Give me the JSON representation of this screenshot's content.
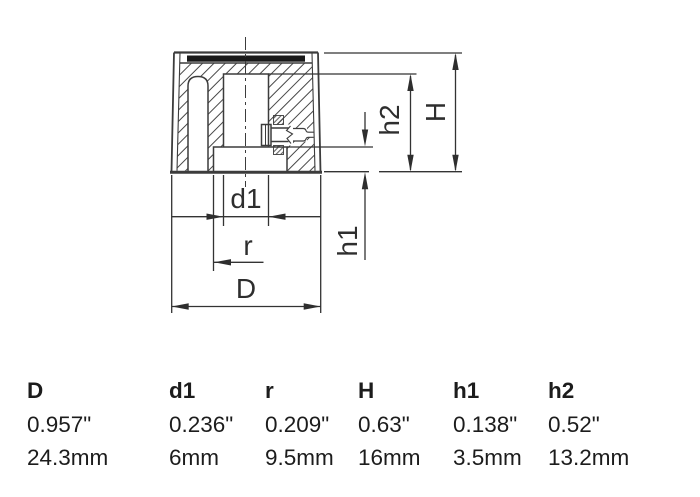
{
  "drawing": {
    "labels": {
      "D": "D",
      "d1": "d1",
      "r": "r",
      "H": "H",
      "h1": "h1",
      "h2": "h2"
    }
  },
  "table": {
    "columns": [
      {
        "label": "D",
        "inches": "0.957\"",
        "mm": "24.3mm"
      },
      {
        "label": "d1",
        "inches": "0.236\"",
        "mm": "6mm"
      },
      {
        "label": "r",
        "inches": "0.209\"",
        "mm": "9.5mm"
      },
      {
        "label": "H",
        "inches": "0.63\"",
        "mm": "16mm"
      },
      {
        "label": "h1",
        "inches": "0.138\"",
        "mm": "3.5mm"
      },
      {
        "label": "h2",
        "inches": "0.52\"",
        "mm": "13.2mm"
      }
    ]
  },
  "colors": {
    "line": "#3c3c3c",
    "dimension_line": "#333333",
    "hatch": "#474747",
    "cap_fill": "#191919",
    "text": "#1c1c1c",
    "background": "#ffffff"
  }
}
